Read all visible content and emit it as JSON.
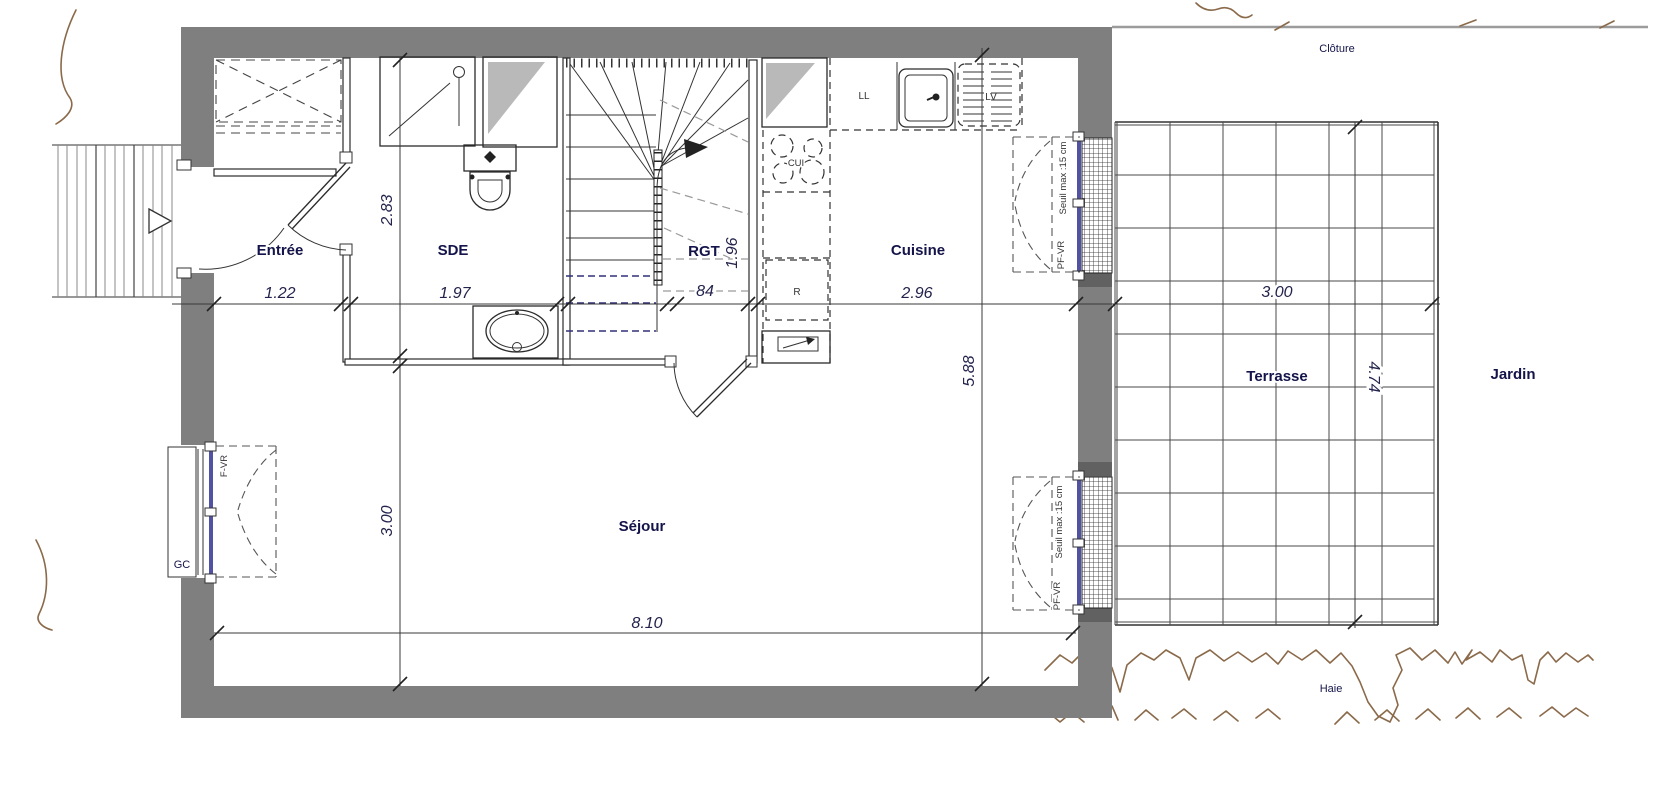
{
  "plan_type": "floor-plan",
  "rooms": {
    "entree": {
      "label": "Entrée",
      "width": "1.22"
    },
    "sde": {
      "label": "SDE",
      "width": "1.97",
      "depth": "2.83"
    },
    "rgt": {
      "label": "RGT",
      "width": "84",
      "depth": "1.96"
    },
    "cuisine": {
      "label": "Cuisine",
      "width": "2.96",
      "depth": "5.88"
    },
    "sejour": {
      "label": "Séjour",
      "width": "8.10",
      "depth": "3.00"
    }
  },
  "exterior": {
    "terrasse": {
      "label": "Terrasse",
      "width": "3.00",
      "depth": "4.74"
    },
    "jardin": {
      "label": "Jardin"
    },
    "cloture": {
      "label": "Clôture"
    },
    "haie": {
      "label": "Haie"
    }
  },
  "openings": {
    "left_window": {
      "type_label": "F-VR",
      "box_label": "GC"
    },
    "kitchen_window": {
      "type_label": "PF-VR",
      "threshold_label": "Seuil max :15 cm"
    },
    "sejour_window": {
      "type_label": "PF-VR",
      "threshold_label": "Seuil max :15 cm"
    }
  },
  "appliances": {
    "washer": "LL",
    "dishwasher": "LV",
    "cooktop": "CUI",
    "fridge": "R"
  },
  "colors": {
    "wall": "#7f7f7f",
    "window_frame": "#5252a5",
    "vegetation": "#8a6a4a",
    "label_text": "#14144a"
  }
}
